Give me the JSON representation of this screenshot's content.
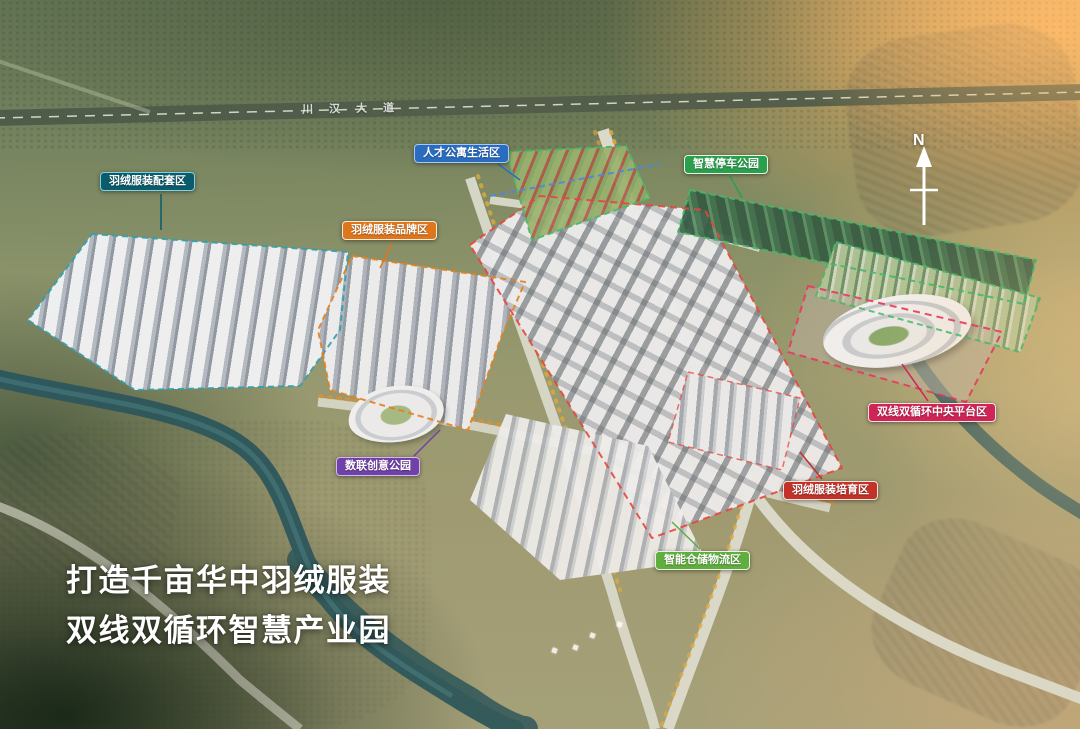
{
  "scene": {
    "title_line1": "打造千亩华中羽绒服装",
    "title_line2": "双线双循环智慧产业园",
    "north_label": "N",
    "road_label": "川汉大道"
  },
  "zones": [
    {
      "id": "support",
      "label": "羽绒服装配套区",
      "color": "#0a5c6c",
      "border": "#7fd2e2",
      "boundary": "#2f9fae"
    },
    {
      "id": "brand",
      "label": "羽绒服装品牌区",
      "color": "#e0761c",
      "border": "#f7ead6",
      "boundary": "#e67f1e"
    },
    {
      "id": "talent-life",
      "label": "人才公寓生活区",
      "color": "#2a6cc0",
      "border": "#a6c8f2",
      "boundary": "#46b868"
    },
    {
      "id": "smart-parking",
      "label": "智慧停车公园",
      "color": "#2aa04c",
      "border": "#e9f5e9",
      "boundary": "#46b868"
    },
    {
      "id": "data-creative",
      "label": "数联创意公园",
      "color": "#7042a8",
      "border": "#d2baee",
      "boundary": "#7042a8"
    },
    {
      "id": "central-platform",
      "label": "双线双循环中央平台区",
      "color": "#cf2455",
      "border": "#f7dfe6",
      "boundary": "#e8385c"
    },
    {
      "id": "incubation",
      "label": "羽绒服装培育区",
      "color": "#c23229",
      "border": "#f2e2da",
      "boundary": "#e8453c"
    },
    {
      "id": "logistics",
      "label": "智能仓储物流区",
      "color": "#5fae3e",
      "border": "#e9f5e0",
      "boundary": "#46b868"
    }
  ]
}
